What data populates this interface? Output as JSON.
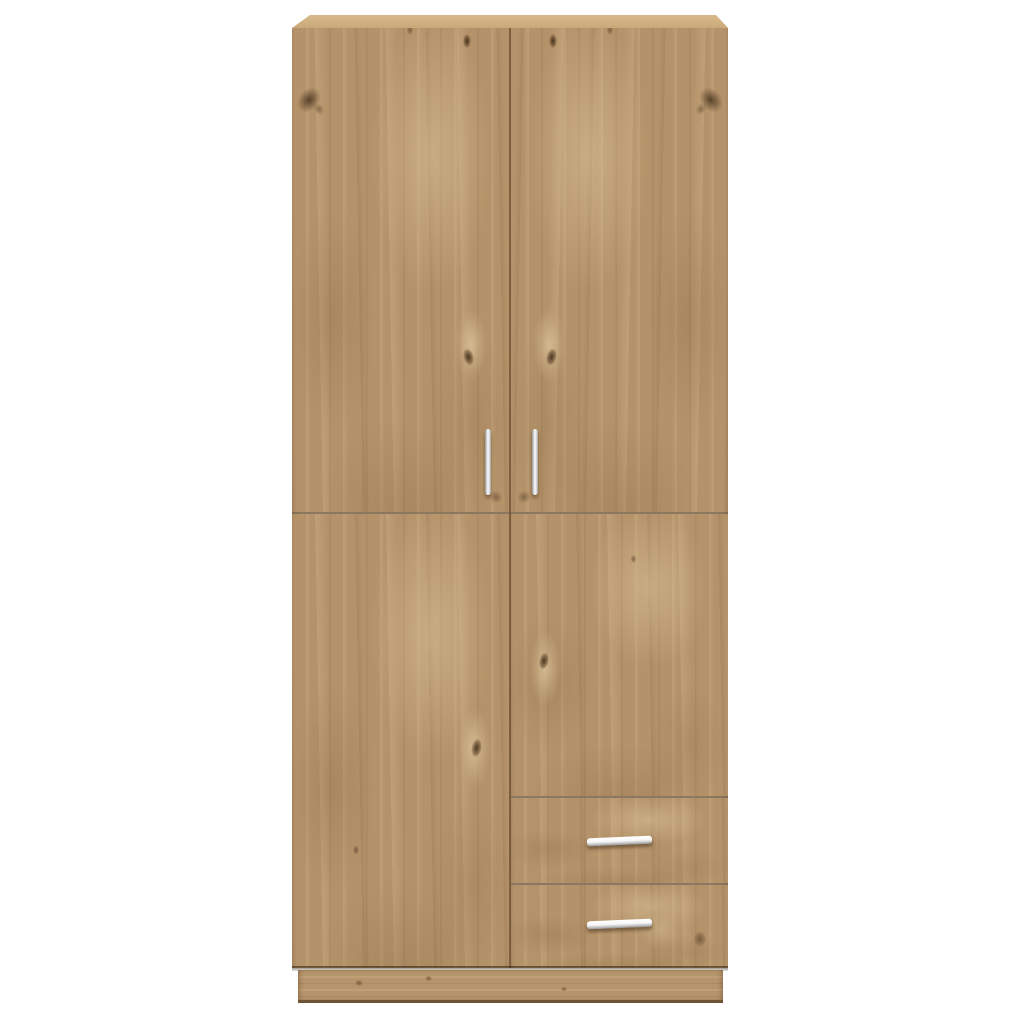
{
  "page": {
    "background_color": "#ffffff",
    "description": "Product photo of an oak-effect wardrobe, viewed straight on, on a plain white background"
  },
  "wardrobe": {
    "finish": "light oak-effect wood with book-matched mirrored grain",
    "colors": {
      "page_bg": "#ffffff",
      "wood_base": "#b5936a",
      "wood_light": "#cfb289",
      "wood_dark": "#8a6a48",
      "knot": "#4f3a22",
      "top_panel": "#c9a97a",
      "seam": "#6b5133",
      "plinth": "#b7956c",
      "handle_light": "#f7f7f7",
      "handle_dark": "#959595"
    },
    "parts": {
      "top_panel": {
        "label": "top panel"
      },
      "upper_left_door": {
        "label": "upper left door with vertical bar handle"
      },
      "upper_right_door": {
        "label": "upper right door with vertical bar handle"
      },
      "lower_left_door": {
        "label": "lower left door"
      },
      "lower_right_door": {
        "label": "lower right door panel"
      },
      "drawer_top": {
        "label": "top drawer with horizontal bar handle"
      },
      "drawer_bottom": {
        "label": "bottom drawer with horizontal bar handle"
      },
      "plinth": {
        "label": "recessed base plinth"
      }
    },
    "counts": {
      "doors": 4,
      "drawers": 2,
      "handles": 4
    }
  }
}
